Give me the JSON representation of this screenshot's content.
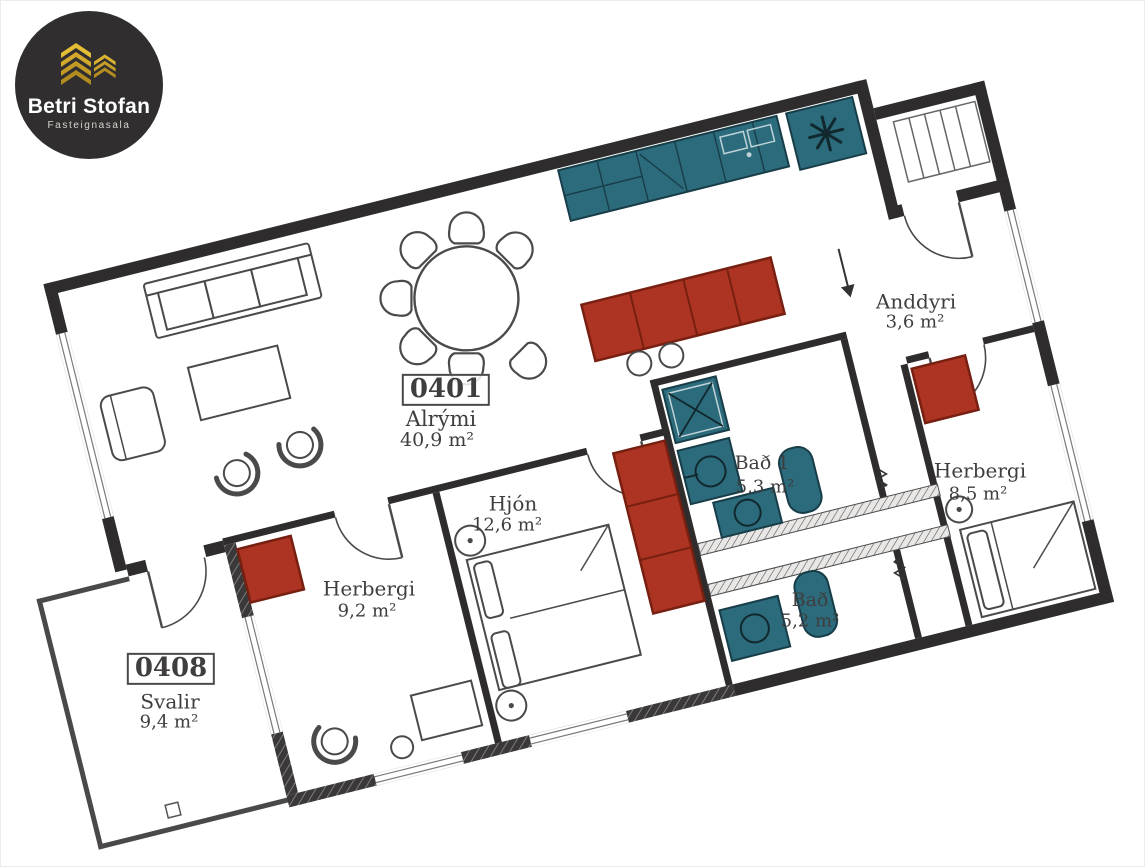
{
  "logo": {
    "title": "Betri Stofan",
    "subtitle": "Fasteignasala"
  },
  "floorplan": {
    "main_unit": "0401",
    "balcony_unit": "0408",
    "rooms": [
      {
        "unit": "0401",
        "name": "Alrými",
        "area": "40,9 m²"
      },
      {
        "name": "Anddyri",
        "area": "3,6 m²"
      },
      {
        "name": "Hjón",
        "area": "12,6 m²"
      },
      {
        "name": "Herbergi",
        "area": "9,2 m²"
      },
      {
        "name": "Bað 1",
        "area": "5,3 m²"
      },
      {
        "name": "Bað",
        "area": "5,2 m²"
      },
      {
        "name": "Herbergi",
        "area": "8,5 m²"
      },
      {
        "unit": "0408",
        "name": "Svalir",
        "area": "9,4 m²"
      }
    ],
    "colors": {
      "walls": "#2e2c2d",
      "fixtures_teal": "#2c6b7c",
      "furniture_red": "#ad3422",
      "logo_bg": "#302e2f",
      "logo_gold": "#cda22b",
      "label_text": "#3f3d3e"
    },
    "icons": [
      "freezer-asterisk-icon",
      "entrance-arrow-icon",
      "sliding-door-arrow-icon",
      "logo-buildings-icon"
    ]
  }
}
